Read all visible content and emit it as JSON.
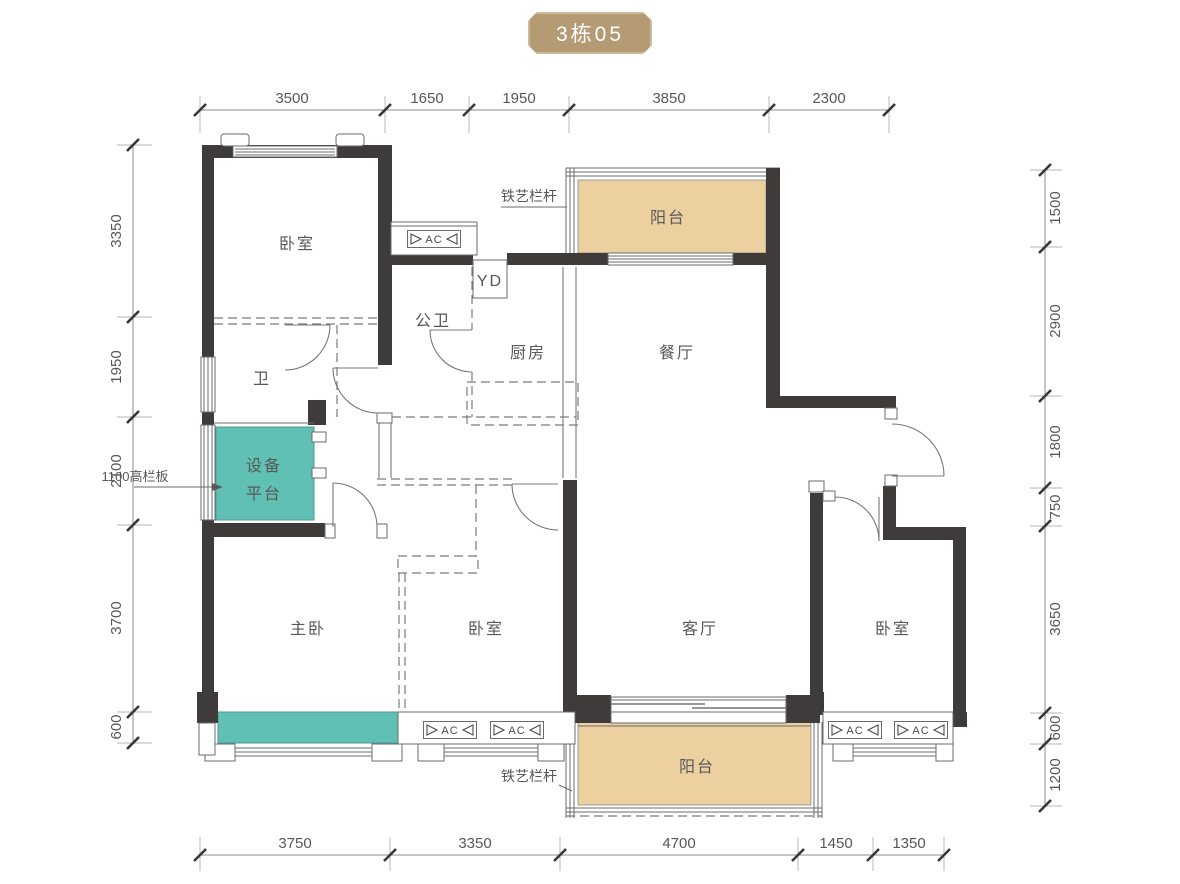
{
  "title": "3栋05",
  "colors": {
    "badge": "#b49b73",
    "balcony": "#ecd0a0",
    "equipment": "#5fc0b3",
    "wall": "#3f3b3a"
  },
  "rooms": {
    "bedroom_top_left": "卧室",
    "bath_master": "卫",
    "bath_public": "公卫",
    "kitchen": "厨房",
    "dining": "餐厅",
    "balcony_top": "阳台",
    "equipment_line1": "设备",
    "equipment_line2": "平台",
    "master_bedroom": "主卧",
    "bedroom_middle": "卧室",
    "living": "客厅",
    "bedroom_right": "卧室",
    "balcony_bottom": "阳台"
  },
  "annotations": {
    "iron_railing_top": "铁艺栏杆",
    "iron_railing_bottom": "铁艺栏杆",
    "guard_panel": "1100高栏板",
    "ac_unit": "AC",
    "yd": "YD"
  },
  "dimensions": {
    "top": [
      "3500",
      "1650",
      "1950",
      "3850",
      "2300"
    ],
    "bottom": [
      "3750",
      "3350",
      "4700",
      "1450",
      "1350"
    ],
    "left": [
      "3350",
      "1950",
      "2100",
      "3700",
      "600"
    ],
    "right": [
      "1500",
      "2900",
      "1800",
      "750",
      "3650",
      "600",
      "1200"
    ]
  }
}
